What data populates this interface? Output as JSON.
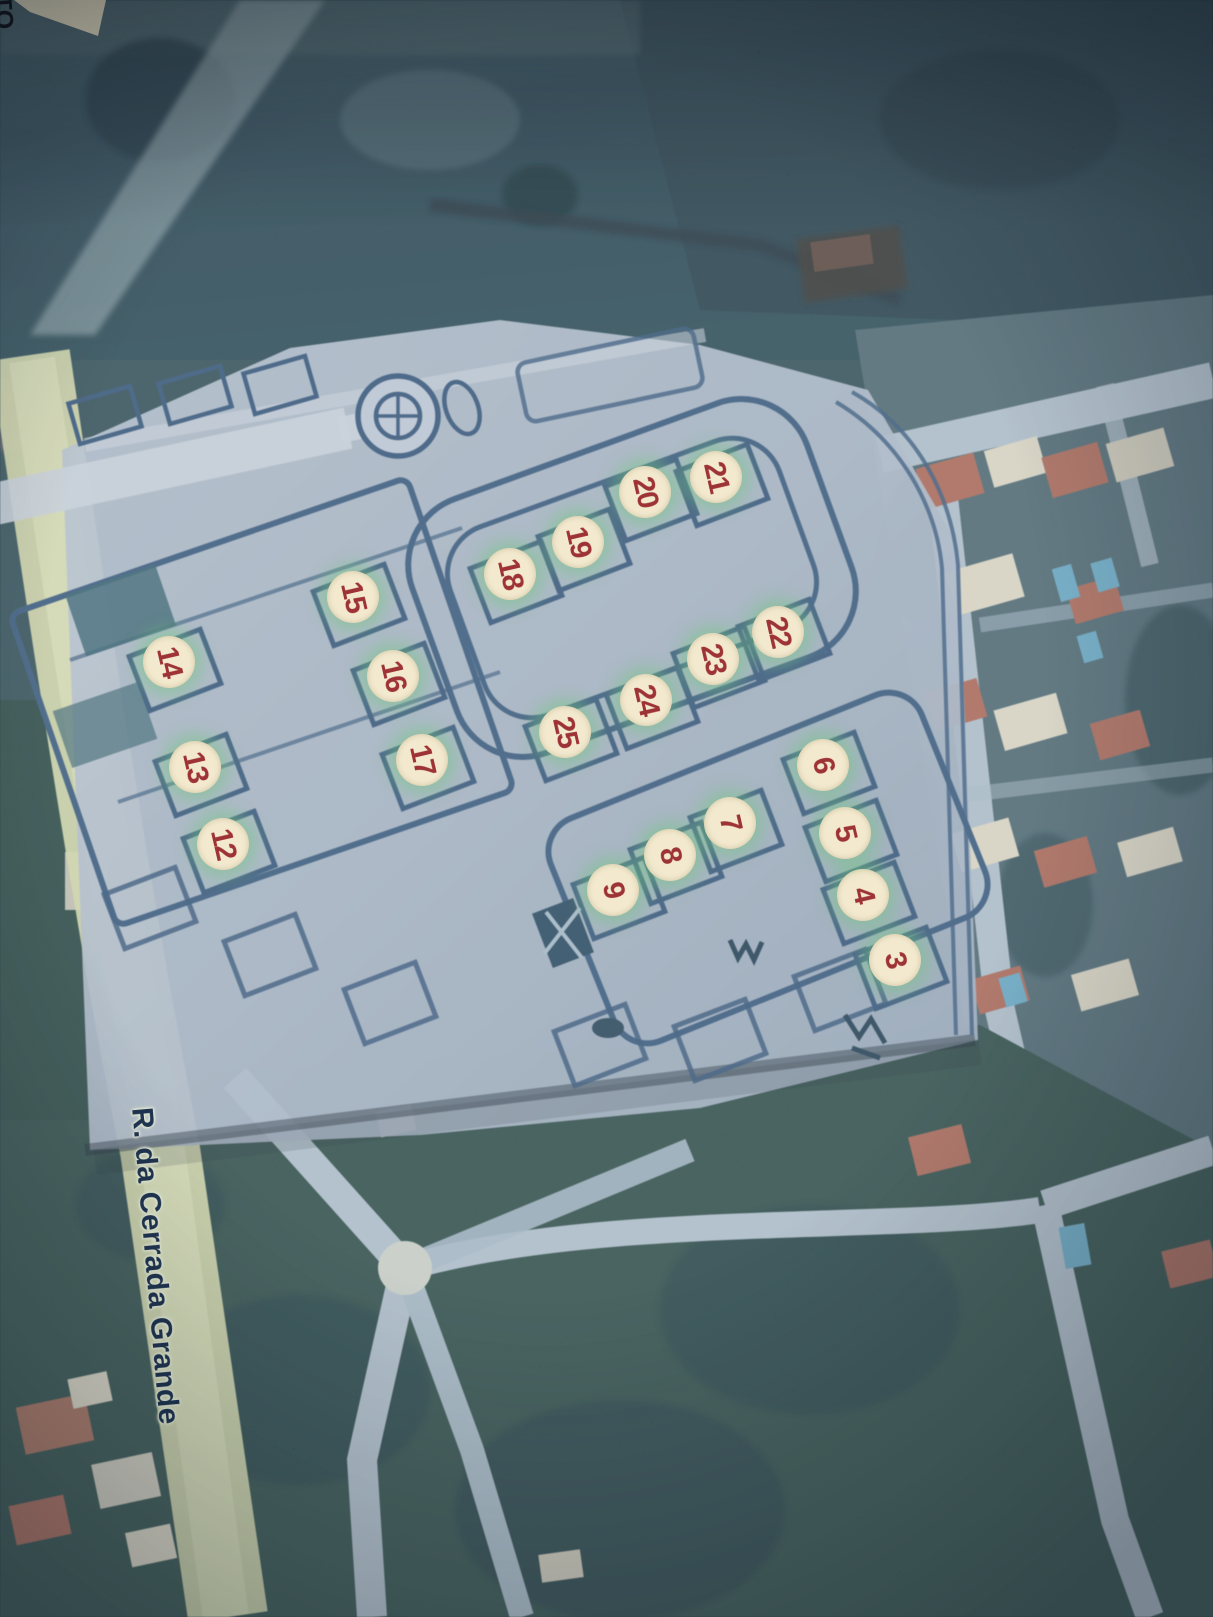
{
  "map": {
    "street_label": "R. da Cerrada Grande",
    "corner_label": "TO",
    "markers": [
      {
        "n": "3",
        "x": 895,
        "y": 960
      },
      {
        "n": "4",
        "x": 863,
        "y": 895
      },
      {
        "n": "5",
        "x": 845,
        "y": 833
      },
      {
        "n": "6",
        "x": 823,
        "y": 765
      },
      {
        "n": "7",
        "x": 730,
        "y": 823
      },
      {
        "n": "8",
        "x": 670,
        "y": 855
      },
      {
        "n": "9",
        "x": 613,
        "y": 890
      },
      {
        "n": "12",
        "x": 223,
        "y": 844
      },
      {
        "n": "13",
        "x": 195,
        "y": 767
      },
      {
        "n": "14",
        "x": 169,
        "y": 662
      },
      {
        "n": "15",
        "x": 353,
        "y": 597
      },
      {
        "n": "16",
        "x": 393,
        "y": 676
      },
      {
        "n": "17",
        "x": 422,
        "y": 760
      },
      {
        "n": "18",
        "x": 510,
        "y": 574
      },
      {
        "n": "19",
        "x": 578,
        "y": 542
      },
      {
        "n": "20",
        "x": 645,
        "y": 492
      },
      {
        "n": "21",
        "x": 716,
        "y": 477
      },
      {
        "n": "22",
        "x": 778,
        "y": 632
      },
      {
        "n": "23",
        "x": 713,
        "y": 659
      },
      {
        "n": "24",
        "x": 646,
        "y": 700
      },
      {
        "n": "25",
        "x": 565,
        "y": 732
      }
    ],
    "colors": {
      "marker_bg": "#f2e9cf",
      "marker_number": "#9e3336",
      "marker_halo_green": "#6ec87d",
      "plan_line": "#2b4d72",
      "plan_overlay": "#a9b6c6",
      "road_yellow_green": "#ced4a6",
      "street_label_text": "#1f3450",
      "dark_field": "#1c3947",
      "roof_red": "#a5604e",
      "pool_blue": "#5fa3c0",
      "corner_paper": "#ece3c6"
    }
  }
}
